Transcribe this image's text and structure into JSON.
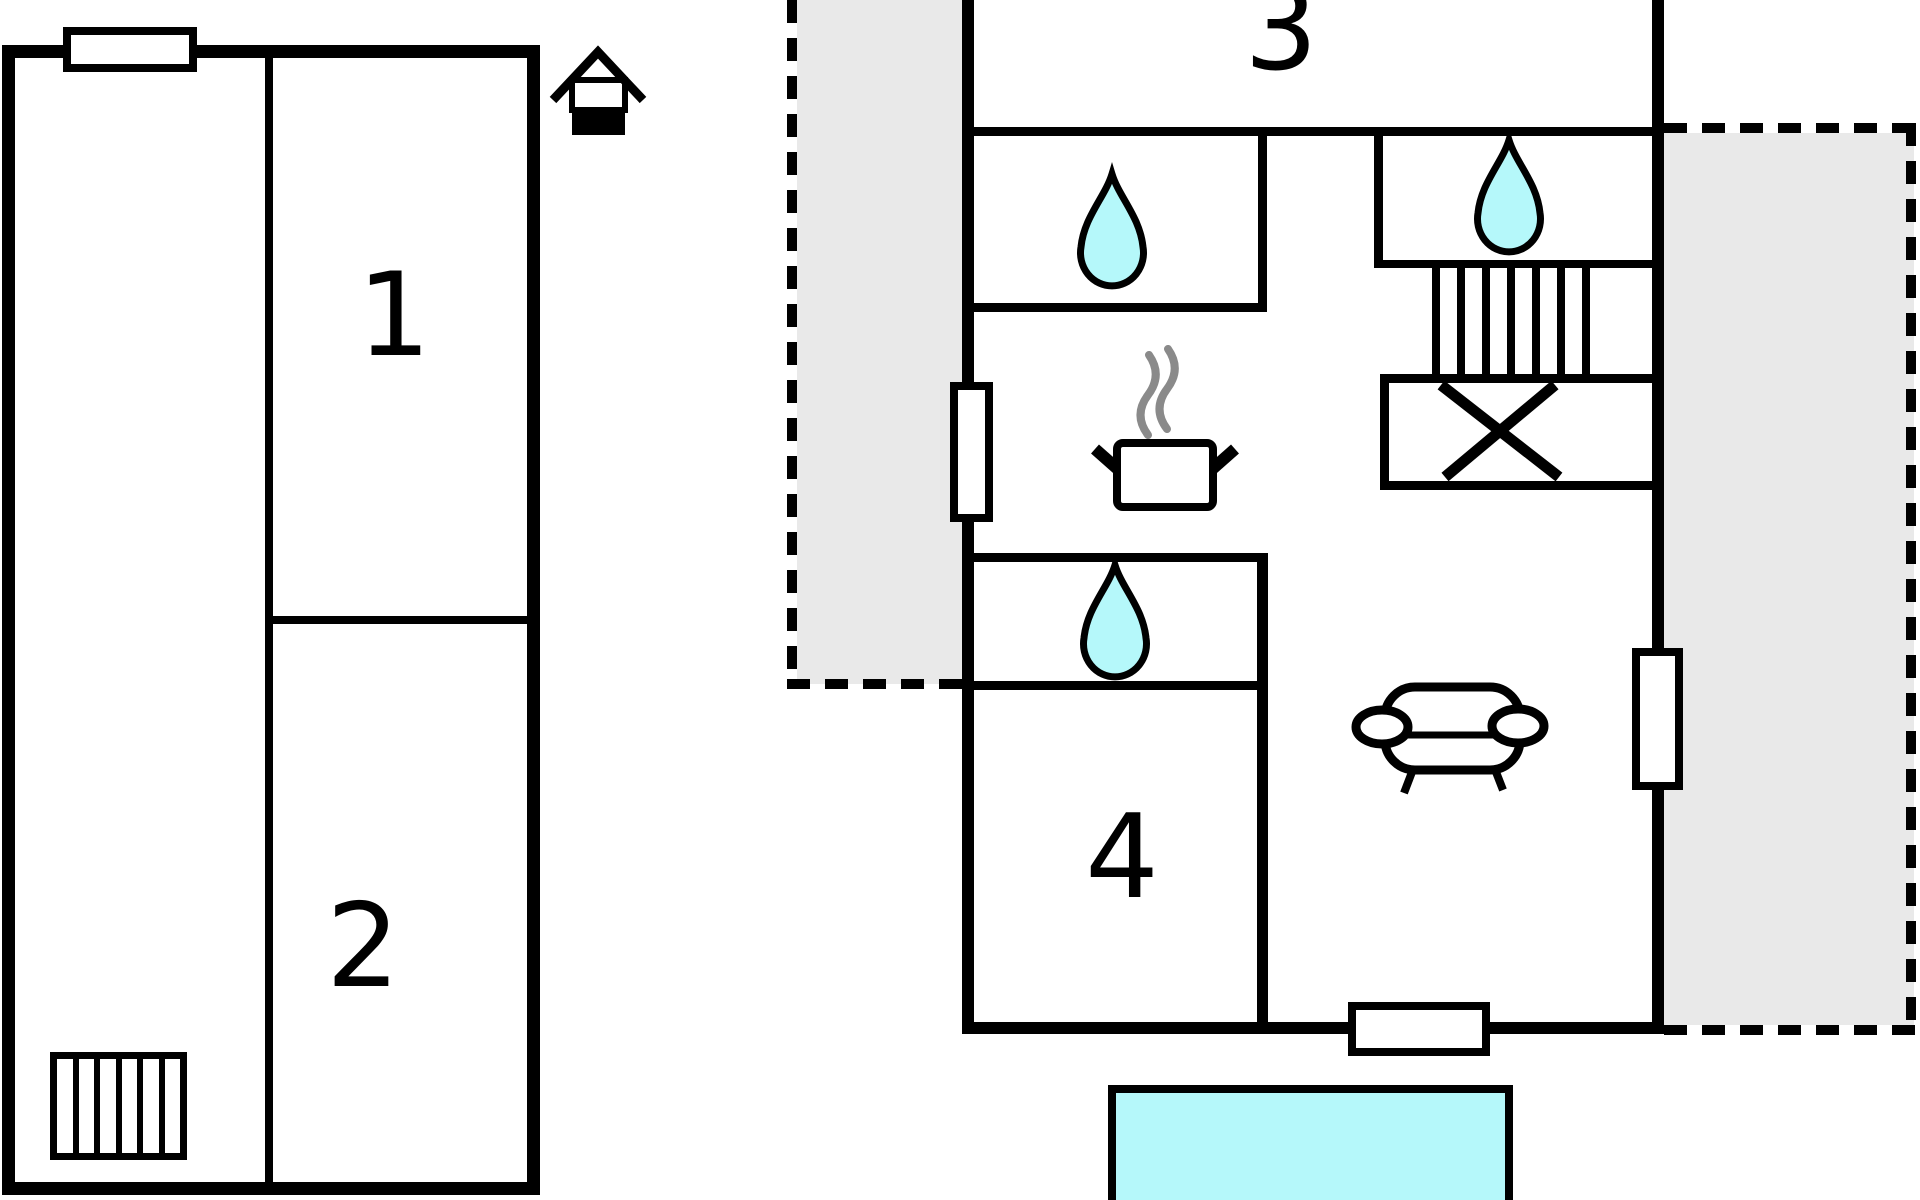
{
  "title": "Two-building floor plan with pool",
  "annex": {
    "room1_label": "1",
    "room2_label": "2"
  },
  "main_house": {
    "room3_label": "3",
    "room4_label": "4"
  },
  "colors": {
    "wall": "#000000",
    "terrace_zone_gray": "#e9e9e9",
    "water_cyan": "#b5f8fa",
    "steam_gray": "#8a8a8a",
    "background": "#ffffff"
  },
  "icons": {
    "house": "house-icon (north/entrance marker)",
    "water_drop": "water-drop-icon (sink/bath fixture)",
    "stove": "stove-pot-icon (pot with steam)",
    "sofa": "sofa-icon (top view couch)",
    "stairs": "stairs-icon (treads)",
    "x_box": "storage-x-icon (crossed box under stairs)"
  }
}
